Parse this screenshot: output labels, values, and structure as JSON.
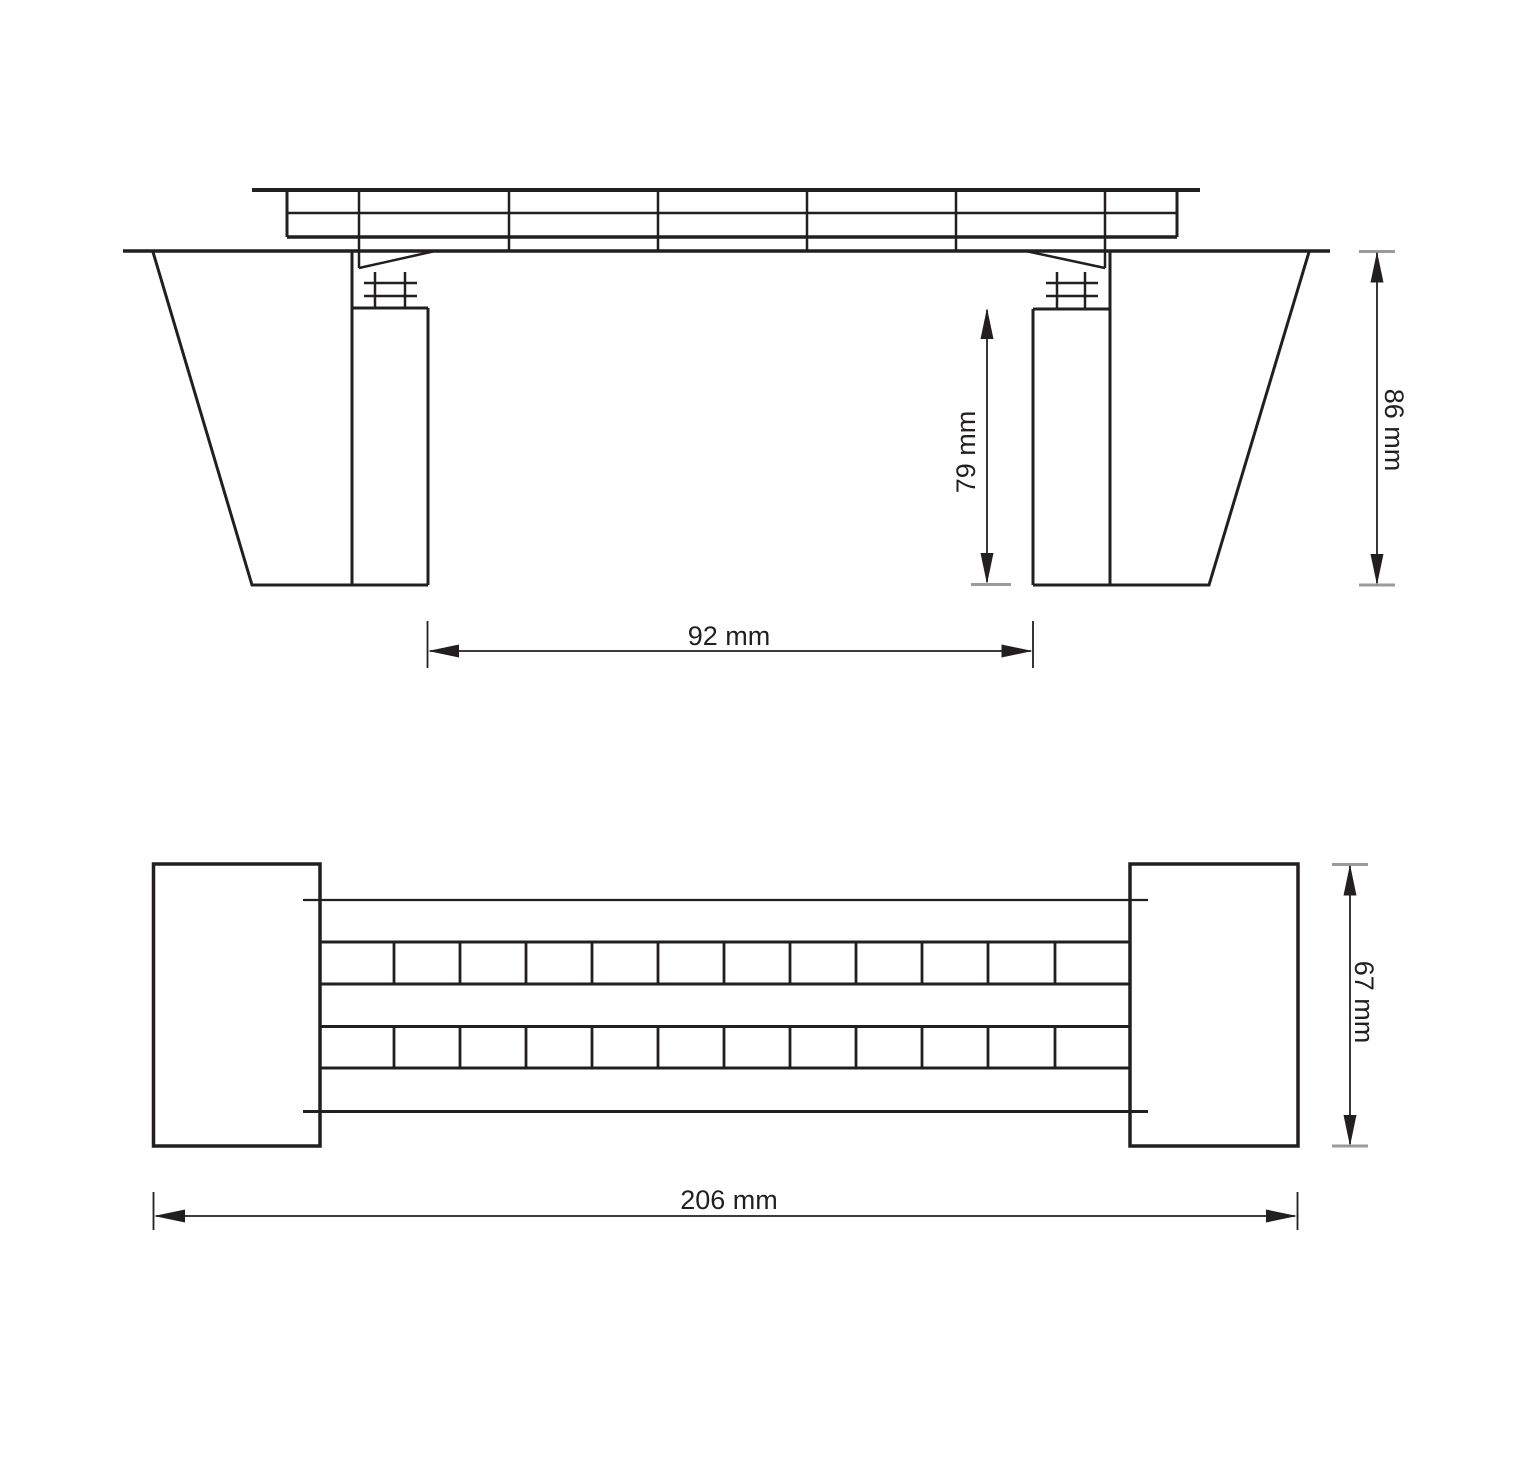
{
  "drawing": {
    "line_color": "#231f20",
    "tick_color": "#9b9b9b",
    "side_elevation": {
      "dim_span": "92 mm",
      "dim_pier_height": "79 mm",
      "dim_total_height": "86 mm"
    },
    "plan_view": {
      "dim_length": "206 mm",
      "dim_width": "67 mm"
    }
  }
}
